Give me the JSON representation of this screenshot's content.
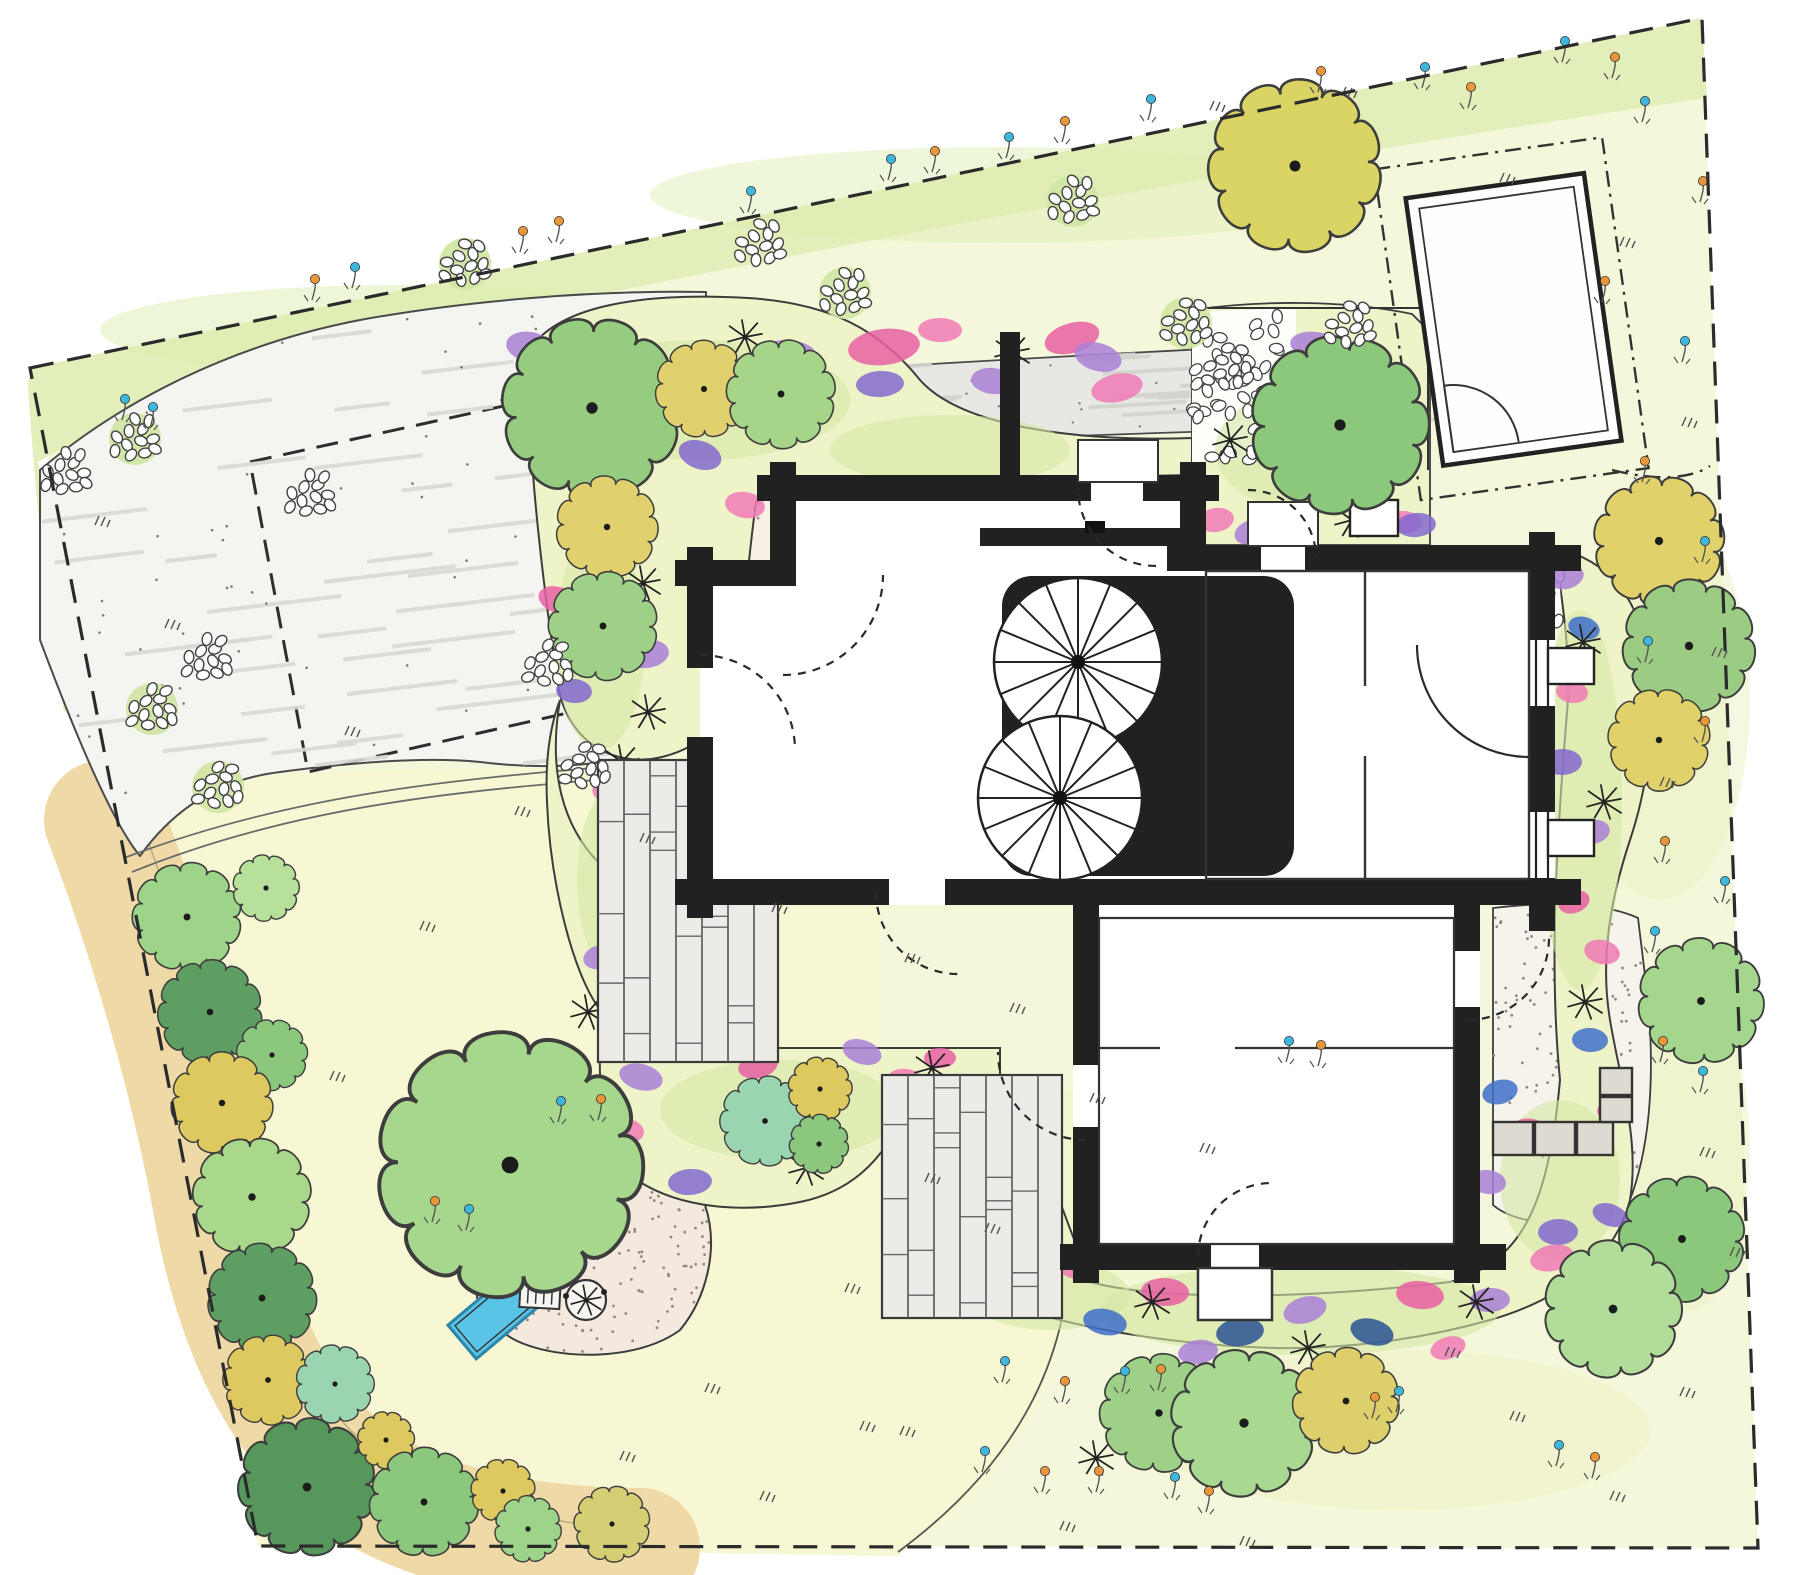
{
  "plan": {
    "kind": "hand-drawn residential garden / landscape site plan",
    "areas": [
      "property-boundary",
      "meadow",
      "grass-verge",
      "gravel-driveway",
      "parking-reserve-dashed",
      "drive-to-garage",
      "garage",
      "house",
      "inner-courtyard-with-tree",
      "entrance-court",
      "timber-decks",
      "lawn",
      "play-area-with-sandpit",
      "perennial-flower-beds",
      "tree-and-shrub-border",
      "gravel-patio-with-stone-wall"
    ]
  },
  "palette": {
    "paper": "#ffffff",
    "meadow": "#f5f7da",
    "verge": "#e3efbb",
    "lawn": "#f7f8d3",
    "gravel": "#f4f4f0",
    "drive": "#e7e7e3",
    "court": "#f9f0e5",
    "patio": "#f6f3ec",
    "sand": "#f3e9df",
    "mulch": "#efdaa7",
    "deck": "#ecebe7",
    "wall": "#212121",
    "stone": "#dcdad1",
    "sandpit": "#5ac4e6",
    "bed": "#eff3c8",
    "bedwash": "#d3e7a5",
    "boundary": "#2b2b2b",
    "flowers": {
      "P": "#f07ab5",
      "K": "#e860a2",
      "V": "#a97fd6",
      "L": "#8468cf",
      "B": "#3f6fc9",
      "D": "#2a5394"
    },
    "dotflowers": {
      "b": "#3fb7dd",
      "o": "#e8953c"
    }
  },
  "trees": [
    [
      187,
      917,
      46,
      "#9ed489"
    ],
    [
      266,
      888,
      28,
      "#b7e09b"
    ],
    [
      210,
      1012,
      44,
      "#5f9e63"
    ],
    [
      272,
      1055,
      30,
      "#8cc77e"
    ],
    [
      222,
      1103,
      43,
      "#ddc95f"
    ],
    [
      252,
      1197,
      50,
      "#a9d88b"
    ],
    [
      262,
      1298,
      46,
      "#5f9e63"
    ],
    [
      268,
      1380,
      38,
      "#ddc95f"
    ],
    [
      335,
      1384,
      33,
      "#9bd4b1"
    ],
    [
      307,
      1487,
      58,
      "#57975c"
    ],
    [
      386,
      1440,
      24,
      "#ddc95f"
    ],
    [
      424,
      1502,
      46,
      "#8cc77e"
    ],
    [
      503,
      1491,
      27,
      "#ddc95f"
    ],
    [
      528,
      1529,
      28,
      "#9ed489"
    ],
    [
      612,
      1524,
      32,
      "#d6ce74"
    ],
    [
      510,
      1165,
      112,
      "#a6d78c"
    ],
    [
      765,
      1121,
      38,
      "#9bd4b1"
    ],
    [
      820,
      1089,
      27,
      "#ddc95f"
    ],
    [
      819,
      1144,
      25,
      "#8cc77e"
    ],
    [
      592,
      408,
      76,
      "#95cc80"
    ],
    [
      704,
      389,
      41,
      "#e0d06e"
    ],
    [
      781,
      394,
      46,
      "#a6d488"
    ],
    [
      607,
      527,
      43,
      "#e0d06e"
    ],
    [
      603,
      626,
      46,
      "#9ed088"
    ],
    [
      1340,
      425,
      75,
      "#8cc87c"
    ],
    [
      1295,
      166,
      73,
      "#d9d464"
    ],
    [
      1659,
      541,
      55,
      "#e0d16b"
    ],
    [
      1689,
      646,
      56,
      "#9ccc84"
    ],
    [
      1659,
      740,
      43,
      "#e0d16b"
    ],
    [
      1701,
      1001,
      53,
      "#a5d68e"
    ],
    [
      1682,
      1239,
      53,
      "#8cc87c"
    ],
    [
      1613,
      1309,
      58,
      "#b2dc9a"
    ],
    [
      1159,
      1413,
      50,
      "#9ed088"
    ],
    [
      1244,
      1423,
      62,
      "#a9d890"
    ],
    [
      1346,
      1401,
      45,
      "#ddcf6b"
    ]
  ],
  "flower_blobs": [
    [
      596,
      360,
      34,
      18,
      "K"
    ],
    [
      530,
      347,
      24,
      15,
      "V"
    ],
    [
      787,
      356,
      30,
      16,
      "V"
    ],
    [
      884,
      347,
      36,
      18,
      "K"
    ],
    [
      1072,
      338,
      28,
      15,
      "K"
    ],
    [
      1098,
      357,
      24,
      14,
      "V"
    ],
    [
      993,
      381,
      22,
      13,
      "V"
    ],
    [
      880,
      384,
      24,
      13,
      "L"
    ],
    [
      1117,
      388,
      26,
      14,
      "P"
    ],
    [
      700,
      455,
      22,
      14,
      "L"
    ],
    [
      745,
      505,
      20,
      13,
      "P"
    ],
    [
      940,
      330,
      22,
      12,
      "P"
    ],
    [
      647,
      654,
      22,
      14,
      "V"
    ],
    [
      735,
      648,
      20,
      13,
      "P"
    ],
    [
      612,
      793,
      20,
      13,
      "P"
    ],
    [
      574,
      691,
      18,
      12,
      "L"
    ],
    [
      646,
      902,
      20,
      13,
      "K"
    ],
    [
      601,
      957,
      18,
      12,
      "V"
    ],
    [
      558,
      600,
      20,
      13,
      "K"
    ],
    [
      1316,
      346,
      26,
      14,
      "V"
    ],
    [
      1300,
      401,
      20,
      12,
      "L"
    ],
    [
      1216,
      520,
      18,
      12,
      "P"
    ],
    [
      1252,
      532,
      18,
      12,
      "V"
    ],
    [
      1352,
      470,
      22,
      13,
      "K"
    ],
    [
      1404,
      522,
      18,
      11,
      "P"
    ],
    [
      1416,
      525,
      20,
      12,
      "L"
    ],
    [
      1566,
      577,
      18,
      12,
      "V"
    ],
    [
      1584,
      628,
      16,
      11,
      "B"
    ],
    [
      1572,
      692,
      16,
      11,
      "P"
    ],
    [
      1562,
      762,
      20,
      13,
      "L"
    ],
    [
      1592,
      832,
      18,
      12,
      "V"
    ],
    [
      1574,
      902,
      16,
      11,
      "K"
    ],
    [
      1602,
      952,
      18,
      12,
      "P"
    ],
    [
      1590,
      1040,
      18,
      12,
      "B"
    ],
    [
      1615,
      1110,
      18,
      12,
      "K"
    ],
    [
      1500,
      1092,
      18,
      12,
      "B"
    ],
    [
      1532,
      1132,
      20,
      13,
      "K"
    ],
    [
      1488,
      1182,
      18,
      12,
      "V"
    ],
    [
      1558,
      1232,
      20,
      13,
      "L"
    ],
    [
      1442,
      1242,
      18,
      12,
      "B"
    ],
    [
      1035,
      1300,
      24,
      14,
      "L"
    ],
    [
      1105,
      1322,
      22,
      13,
      "B"
    ],
    [
      1165,
      1292,
      24,
      14,
      "K"
    ],
    [
      1240,
      1332,
      24,
      14,
      "D"
    ],
    [
      1305,
      1310,
      22,
      13,
      "V"
    ],
    [
      1372,
      1332,
      22,
      13,
      "D"
    ],
    [
      1420,
      1295,
      24,
      14,
      "K"
    ],
    [
      1490,
      1300,
      20,
      12,
      "V"
    ],
    [
      1552,
      1258,
      22,
      13,
      "P"
    ],
    [
      1610,
      1215,
      18,
      11,
      "L"
    ],
    [
      962,
      1280,
      20,
      12,
      "B"
    ],
    [
      1078,
      1268,
      18,
      11,
      "P"
    ],
    [
      1198,
      1352,
      20,
      12,
      "V"
    ],
    [
      1448,
      1348,
      18,
      11,
      "P"
    ],
    [
      641,
      1077,
      22,
      13,
      "V"
    ],
    [
      624,
      1131,
      20,
      13,
      "P"
    ],
    [
      690,
      1182,
      22,
      13,
      "L"
    ],
    [
      758,
      1066,
      20,
      12,
      "K"
    ],
    [
      862,
      1052,
      20,
      12,
      "V"
    ],
    [
      906,
      1080,
      18,
      11,
      "P"
    ],
    [
      940,
      1058,
      16,
      10,
      "K"
    ]
  ],
  "plant_stars": [
    [
      745,
      337
    ],
    [
      1012,
      352
    ],
    [
      1106,
      462
    ],
    [
      643,
      583
    ],
    [
      622,
      762
    ],
    [
      588,
      1012
    ],
    [
      932,
      1068
    ],
    [
      806,
      1168
    ],
    [
      1152,
      1302
    ],
    [
      1308,
      1348
    ],
    [
      1476,
      1302
    ],
    [
      1583,
      642
    ],
    [
      1604,
      802
    ],
    [
      1352,
      520
    ],
    [
      1230,
      440
    ],
    [
      1096,
      1458
    ],
    [
      1585,
      1002
    ],
    [
      648,
      712
    ]
  ],
  "meadow_flowers": [
    [
      122,
      420,
      "b"
    ],
    [
      150,
      428,
      "b"
    ],
    [
      312,
      300,
      "o"
    ],
    [
      352,
      288,
      "b"
    ],
    [
      520,
      252,
      "o"
    ],
    [
      556,
      242,
      "o"
    ],
    [
      748,
      212,
      "b"
    ],
    [
      888,
      180,
      "b"
    ],
    [
      932,
      172,
      "o"
    ],
    [
      1006,
      158,
      "b"
    ],
    [
      1062,
      142,
      "o"
    ],
    [
      1148,
      120,
      "b"
    ],
    [
      1318,
      92,
      "o"
    ],
    [
      1422,
      88,
      "b"
    ],
    [
      1468,
      108,
      "o"
    ],
    [
      1562,
      62,
      "b"
    ],
    [
      1612,
      78,
      "o"
    ],
    [
      1642,
      122,
      "b"
    ],
    [
      1700,
      202,
      "o"
    ],
    [
      1602,
      302,
      "o"
    ],
    [
      1682,
      362,
      "b"
    ],
    [
      1642,
      482,
      "o"
    ],
    [
      1702,
      562,
      "b"
    ],
    [
      1645,
      662,
      "b"
    ],
    [
      1702,
      742,
      "o"
    ],
    [
      1662,
      862,
      "o"
    ],
    [
      1722,
      902,
      "b"
    ],
    [
      1652,
      952,
      "b"
    ],
    [
      1002,
      1382,
      "b"
    ],
    [
      1062,
      1402,
      "o"
    ],
    [
      982,
      1472,
      "b"
    ],
    [
      1042,
      1492,
      "o"
    ],
    [
      1122,
      1392,
      "b"
    ],
    [
      1158,
      1390,
      "o"
    ],
    [
      1096,
      1492,
      "o"
    ],
    [
      1172,
      1498,
      "b"
    ],
    [
      1206,
      1512,
      "o"
    ],
    [
      1372,
      1418,
      "o"
    ],
    [
      1396,
      1412,
      "b"
    ],
    [
      1556,
      1466,
      "b"
    ],
    [
      1592,
      1478,
      "o"
    ],
    [
      1286,
      1062,
      "b"
    ],
    [
      1318,
      1066,
      "o"
    ],
    [
      1660,
      1062,
      "o"
    ],
    [
      1700,
      1092,
      "b"
    ],
    [
      558,
      1122,
      "b"
    ],
    [
      598,
      1120,
      "o"
    ],
    [
      432,
      1222,
      "o"
    ],
    [
      466,
      1230,
      "b"
    ]
  ],
  "grass_tufts": [
    [
      95,
      525
    ],
    [
      165,
      628
    ],
    [
      345,
      735
    ],
    [
      515,
      815
    ],
    [
      640,
      842
    ],
    [
      772,
      912
    ],
    [
      905,
      962
    ],
    [
      1010,
      1012
    ],
    [
      845,
      1292
    ],
    [
      705,
      1392
    ],
    [
      925,
      1182
    ],
    [
      985,
      1232
    ],
    [
      1090,
      1102
    ],
    [
      1200,
      1152
    ],
    [
      620,
      1460
    ],
    [
      760,
      1500
    ],
    [
      860,
      1430
    ],
    [
      1445,
      1356
    ],
    [
      1510,
      1420
    ],
    [
      1610,
      1500
    ],
    [
      1680,
      1396
    ],
    [
      1730,
      1256
    ],
    [
      1700,
      1156
    ],
    [
      1660,
      786
    ],
    [
      1712,
      656
    ],
    [
      1682,
      426
    ],
    [
      1620,
      246
    ],
    [
      1500,
      182
    ],
    [
      1342,
      96
    ],
    [
      1210,
      110
    ],
    [
      900,
      1435
    ],
    [
      1060,
      1530
    ],
    [
      1240,
      1545
    ],
    [
      420,
      930
    ],
    [
      330,
      1080
    ]
  ],
  "pebble_clusters": [
    [
      465,
      268,
      1
    ],
    [
      760,
      248,
      0
    ],
    [
      845,
      297,
      1
    ],
    [
      1073,
      205,
      1
    ],
    [
      135,
      443,
      1
    ],
    [
      66,
      477,
      0
    ],
    [
      310,
      499,
      0
    ],
    [
      207,
      663,
      0
    ],
    [
      152,
      713,
      1
    ],
    [
      548,
      669,
      0
    ],
    [
      218,
      791,
      1
    ],
    [
      585,
      771,
      0
    ],
    [
      1228,
      372,
      0
    ],
    [
      1186,
      327,
      1
    ],
    [
      1350,
      330,
      0
    ]
  ],
  "ground_washes": [
    [
      350,
      950,
      260,
      120,
      "#f0f4c0",
      0.55
    ],
    [
      700,
      1250,
      300,
      150,
      "#f2f5c6",
      0.5
    ],
    [
      1150,
      1180,
      200,
      100,
      "#eef3be",
      0.45
    ],
    [
      400,
      330,
      300,
      45,
      "#dcedb0",
      0.5
    ],
    [
      1000,
      195,
      350,
      48,
      "#dcedb0",
      0.45
    ],
    [
      1660,
      700,
      90,
      200,
      "#ecf2c2",
      0.5
    ],
    [
      1400,
      1430,
      250,
      80,
      "#edf2c2",
      0.5
    ],
    [
      520,
      1165,
      130,
      90,
      "#e9f2b8",
      0.45
    ],
    [
      250,
      860,
      120,
      60,
      "#eef3c0",
      0.5
    ],
    [
      1690,
      1150,
      60,
      160,
      "#ecf2c2",
      0.5
    ]
  ],
  "bed_washes": [
    [
      700,
      400,
      150,
      60
    ],
    [
      950,
      450,
      120,
      35
    ],
    [
      600,
      640,
      45,
      110
    ],
    [
      1580,
      800,
      42,
      190
    ],
    [
      1300,
      1310,
      200,
      45
    ],
    [
      1050,
      1295,
      80,
      35
    ],
    [
      780,
      1110,
      120,
      50
    ],
    [
      1310,
      450,
      95,
      62
    ],
    [
      612,
      880,
      35,
      90
    ],
    [
      1560,
      1180,
      60,
      80
    ]
  ],
  "decks": [
    {
      "x": 598,
      "y": 760,
      "w": 180,
      "h": 302
    },
    {
      "x": 882,
      "y": 1075,
      "w": 180,
      "h": 243
    }
  ],
  "play_area": {
    "benches": [
      {
        "x": 563,
        "y": 1243,
        "rot": -25
      },
      {
        "x": 540,
        "y": 1294,
        "rot": 3
      }
    ],
    "sandpit": {
      "x": 505,
      "y": 1306,
      "rot": -40,
      "w": 112,
      "h": 44
    },
    "tree_ring": {
      "x": 586,
      "y": 1300,
      "r": 20
    }
  },
  "house": {
    "stairs": [
      {
        "x": 1078,
        "y": 662,
        "r": 84,
        "spokes": 16
      },
      {
        "x": 1060,
        "y": 798,
        "r": 82,
        "spokes": 16
      }
    ]
  }
}
